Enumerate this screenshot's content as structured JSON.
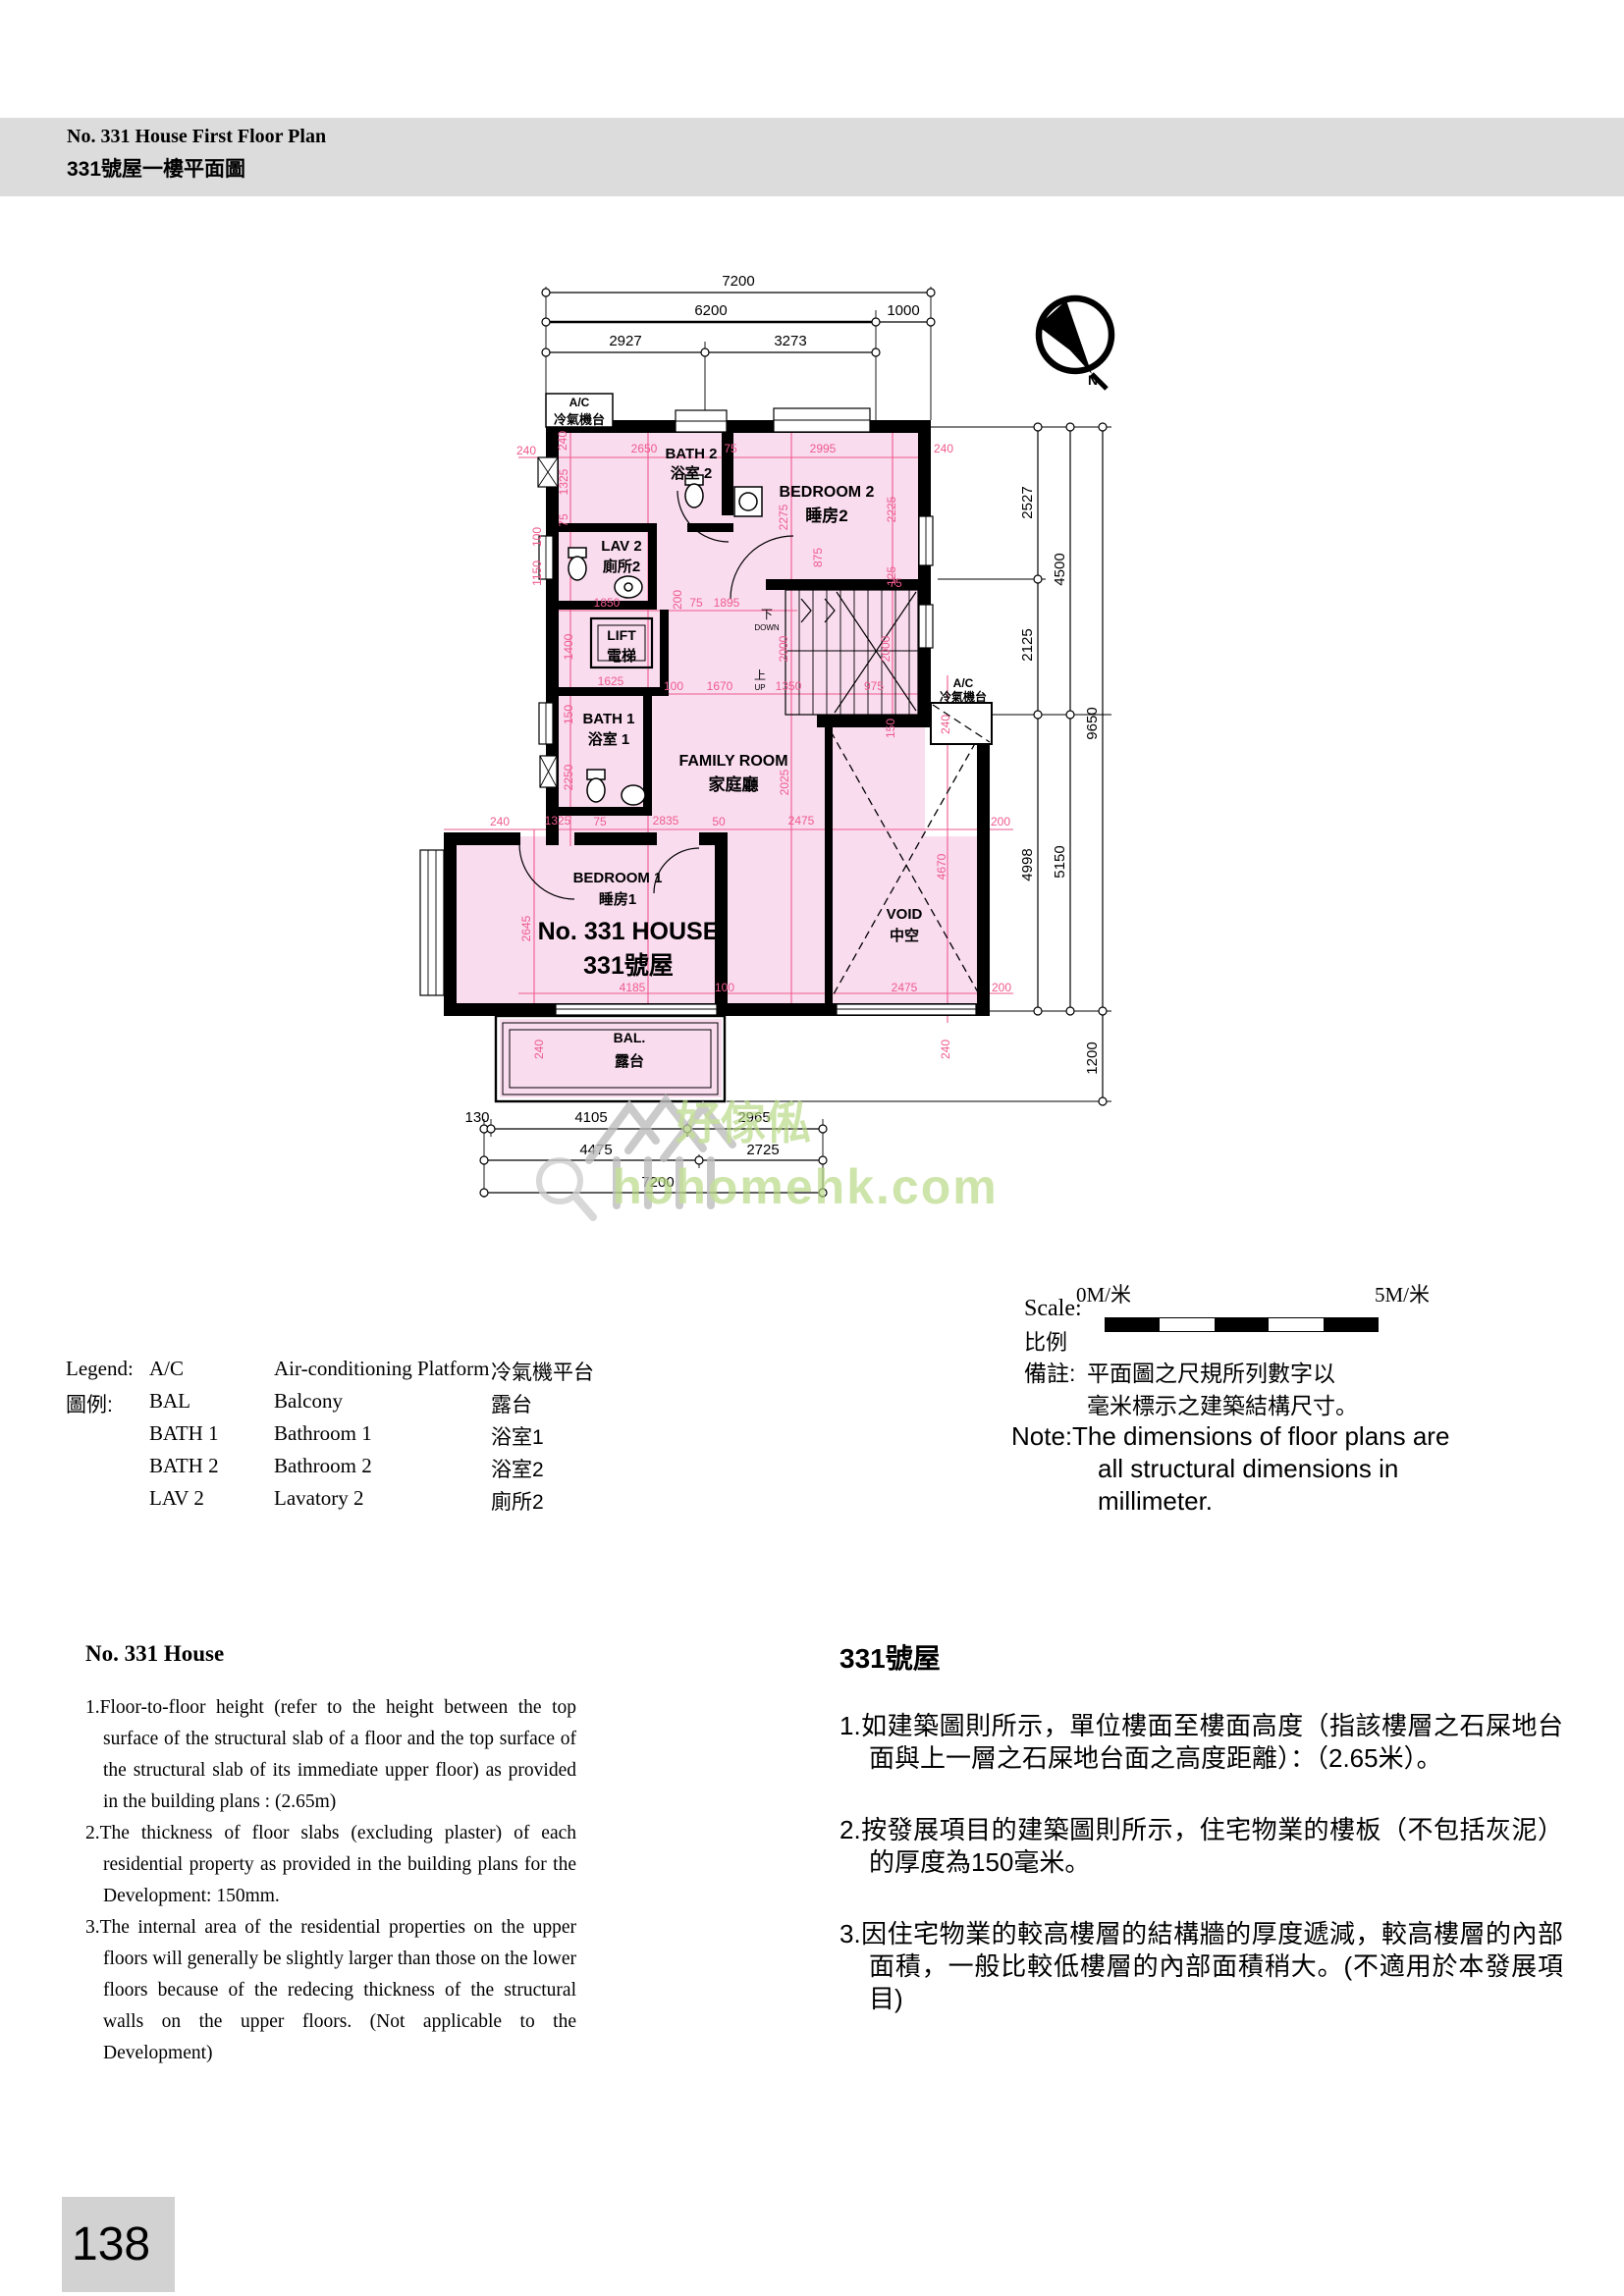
{
  "header": {
    "title_en": "No. 331 House First Floor Plan",
    "title_zh": "331號屋一樓平面圖"
  },
  "plan": {
    "house_en": "No. 331 HOUSE",
    "house_zh": "331號屋",
    "north_label": "N",
    "stair_down_zh": "下",
    "stair_down_en": "DOWN",
    "stair_up_zh": "上",
    "stair_up_en": "UP",
    "rooms": [
      [
        "BATH 2",
        "浴室 2",
        704,
        467,
        487,
        15,
        15
      ],
      [
        "BEDROOM 2",
        "睡房2",
        842,
        506,
        531,
        16,
        17
      ],
      [
        "LAV 2",
        "廁所2",
        633,
        561,
        582,
        15,
        15
      ],
      [
        "LIFT",
        "電梯",
        633,
        652,
        673,
        14,
        15
      ],
      [
        "BATH 1",
        "浴室 1",
        620,
        737,
        758,
        15,
        15
      ],
      [
        "FAMILY ROOM",
        "家庭廳",
        747,
        780,
        805,
        16,
        17
      ],
      [
        "BEDROOM 1",
        "睡房1",
        629,
        899,
        921,
        15,
        15
      ],
      [
        "VOID",
        "中空",
        921,
        936,
        958,
        15,
        15
      ],
      [
        "BAL.",
        "露台",
        641,
        1062,
        1086,
        14,
        15
      ],
      [
        "A/C",
        "冷氣機台",
        590,
        414,
        432,
        12,
        13
      ],
      [
        "A/C",
        "冷氣機台",
        981,
        700,
        714,
        12,
        12
      ]
    ],
    "dims": [
      [
        "7200",
        752,
        291,
        0,
        "k"
      ],
      [
        "6200",
        724,
        321,
        0,
        "k"
      ],
      [
        "1000",
        920,
        321,
        0,
        "k"
      ],
      [
        "2927",
        637,
        352,
        0,
        "k"
      ],
      [
        "3273",
        805,
        352,
        0,
        "k"
      ],
      [
        "2527",
        1051,
        512,
        1,
        "k"
      ],
      [
        "4500",
        1084,
        580,
        1,
        "k"
      ],
      [
        "2125",
        1051,
        657,
        1,
        "k"
      ],
      [
        "9650",
        1117,
        737,
        1,
        "k"
      ],
      [
        "4998",
        1051,
        881,
        1,
        "k"
      ],
      [
        "5150",
        1084,
        878,
        1,
        "k"
      ],
      [
        "1200",
        1117,
        1078,
        1,
        "k"
      ],
      [
        "130",
        486,
        1143,
        0,
        "k"
      ],
      [
        "4105",
        602,
        1143,
        0,
        "k"
      ],
      [
        "2965",
        768,
        1143,
        0,
        "k"
      ],
      [
        "4475",
        607,
        1176,
        0,
        "k"
      ],
      [
        "2725",
        777,
        1176,
        0,
        "k"
      ],
      [
        "7200",
        670,
        1209,
        0,
        "k"
      ],
      [
        "240",
        536,
        463,
        0,
        "p"
      ],
      [
        "240",
        577,
        449,
        1,
        "p"
      ],
      [
        "2650",
        656,
        461,
        0,
        "p"
      ],
      [
        "75",
        744,
        461,
        0,
        "p"
      ],
      [
        "2995",
        838,
        461,
        0,
        "p"
      ],
      [
        "240",
        961,
        461,
        0,
        "p"
      ],
      [
        "1325",
        578,
        491,
        1,
        "p"
      ],
      [
        "75",
        578,
        530,
        1,
        "p"
      ],
      [
        "2275",
        802,
        527,
        1,
        "p"
      ],
      [
        "2225",
        912,
        519,
        1,
        "p"
      ],
      [
        "875",
        837,
        568,
        1,
        "p"
      ],
      [
        "125",
        912,
        587,
        1,
        "p"
      ],
      [
        "100",
        551,
        547,
        1,
        "p"
      ],
      [
        "1150",
        551,
        584,
        1,
        "p"
      ],
      [
        "1850",
        618,
        618,
        0,
        "p"
      ],
      [
        "200",
        694,
        611,
        1,
        "p"
      ],
      [
        "75",
        709,
        618,
        0,
        "p"
      ],
      [
        "1895",
        740,
        618,
        0,
        "p"
      ],
      [
        "75",
        912,
        598,
        0,
        "p"
      ],
      [
        "1400",
        583,
        659,
        1,
        "p"
      ],
      [
        "2000",
        802,
        661,
        1,
        "p"
      ],
      [
        "2000",
        906,
        661,
        1,
        "p"
      ],
      [
        "1625",
        622,
        698,
        0,
        "p"
      ],
      [
        "150",
        583,
        728,
        1,
        "p"
      ],
      [
        "100",
        686,
        703,
        0,
        "p"
      ],
      [
        "1670",
        733,
        703,
        0,
        "p"
      ],
      [
        "1350",
        803,
        703,
        0,
        "p"
      ],
      [
        "975",
        890,
        703,
        0,
        "p"
      ],
      [
        "150",
        911,
        742,
        1,
        "p"
      ],
      [
        "240",
        967,
        738,
        1,
        "p"
      ],
      [
        "2250",
        583,
        792,
        1,
        "p"
      ],
      [
        "2025",
        803,
        797,
        1,
        "p"
      ],
      [
        "240",
        509,
        841,
        0,
        "p"
      ],
      [
        "1325",
        568,
        840,
        0,
        "p"
      ],
      [
        "75",
        611,
        841,
        0,
        "p"
      ],
      [
        "2835",
        678,
        840,
        0,
        "p"
      ],
      [
        "50",
        732,
        841,
        0,
        "p"
      ],
      [
        "2475",
        816,
        840,
        0,
        "p"
      ],
      [
        "200",
        1019,
        841,
        0,
        "p"
      ],
      [
        "2645",
        540,
        946,
        1,
        "p"
      ],
      [
        "4670",
        963,
        883,
        1,
        "p"
      ],
      [
        "4185",
        644,
        1010,
        0,
        "p"
      ],
      [
        "100",
        738,
        1010,
        0,
        "p"
      ],
      [
        "2475",
        921,
        1010,
        0,
        "p"
      ],
      [
        "200",
        1020,
        1010,
        0,
        "p"
      ],
      [
        "240",
        553,
        1069,
        1,
        "p"
      ],
      [
        "240",
        967,
        1069,
        1,
        "p"
      ]
    ]
  },
  "watermark": {
    "cn": "好傢俬",
    "domain": "hohomehk.com"
  },
  "scale": {
    "label_en": "Scale:",
    "label_zh": "比例",
    "zero": "0M/米",
    "five": "5M/米"
  },
  "legend": {
    "label_en": "Legend:",
    "label_zh": "圖例:",
    "rows": [
      [
        "A/C",
        "Air-conditioning Platform",
        "冷氣機平台"
      ],
      [
        "BAL",
        "Balcony",
        "露台"
      ],
      [
        "BATH 1",
        "Bathroom 1",
        "浴室1"
      ],
      [
        "BATH 2",
        "Bathroom 2",
        "浴室2"
      ],
      [
        "LAV 2",
        "Lavatory 2",
        "廁所2"
      ]
    ]
  },
  "remark": {
    "zh_prefix": "備註:",
    "zh_line1": "平面圖之尺規所列數字以",
    "zh_line2": "毫米標示之建築結構尺寸。",
    "en_prefix": "Note:",
    "en_line1": "The dimensions of floor plans are",
    "en_line2": "all structural dimensions in",
    "en_line3": "millimeter."
  },
  "notes_en": {
    "heading": "No. 331 House",
    "items": [
      "1.Floor-to-floor height (refer to the height between the top surface of the structural slab of a floor and the top surface of the structural slab of its immediate upper floor) as provided in the building plans : (2.65m)",
      "2.The thickness of floor slabs (excluding plaster) of each residential property as provided in the building plans for the Development: 150mm.",
      "3.The internal area of the residential properties on the upper floors will generally be slightly larger than those on the lower floors because of the redecing thickness of the structural walls on the upper floors. (Not applicable to the Development)"
    ]
  },
  "notes_zh": {
    "heading": "331號屋",
    "items": [
      "1.如建築圖則所示，單位樓面至樓面高度（指該樓層之石屎地台面與上一層之石屎地台面之高度距離）：（2.65米）。",
      "2.按發展項目的建築圖則所示，住宅物業的樓板（不包括灰泥）的厚度為150毫米。",
      "3.因住宅物業的較高樓層的結構牆的厚度遞減，較高樓層的內部面積，一般比較低樓層的內部面積稍大。(不適用於本發展項目)"
    ]
  },
  "page": {
    "number": "138"
  }
}
